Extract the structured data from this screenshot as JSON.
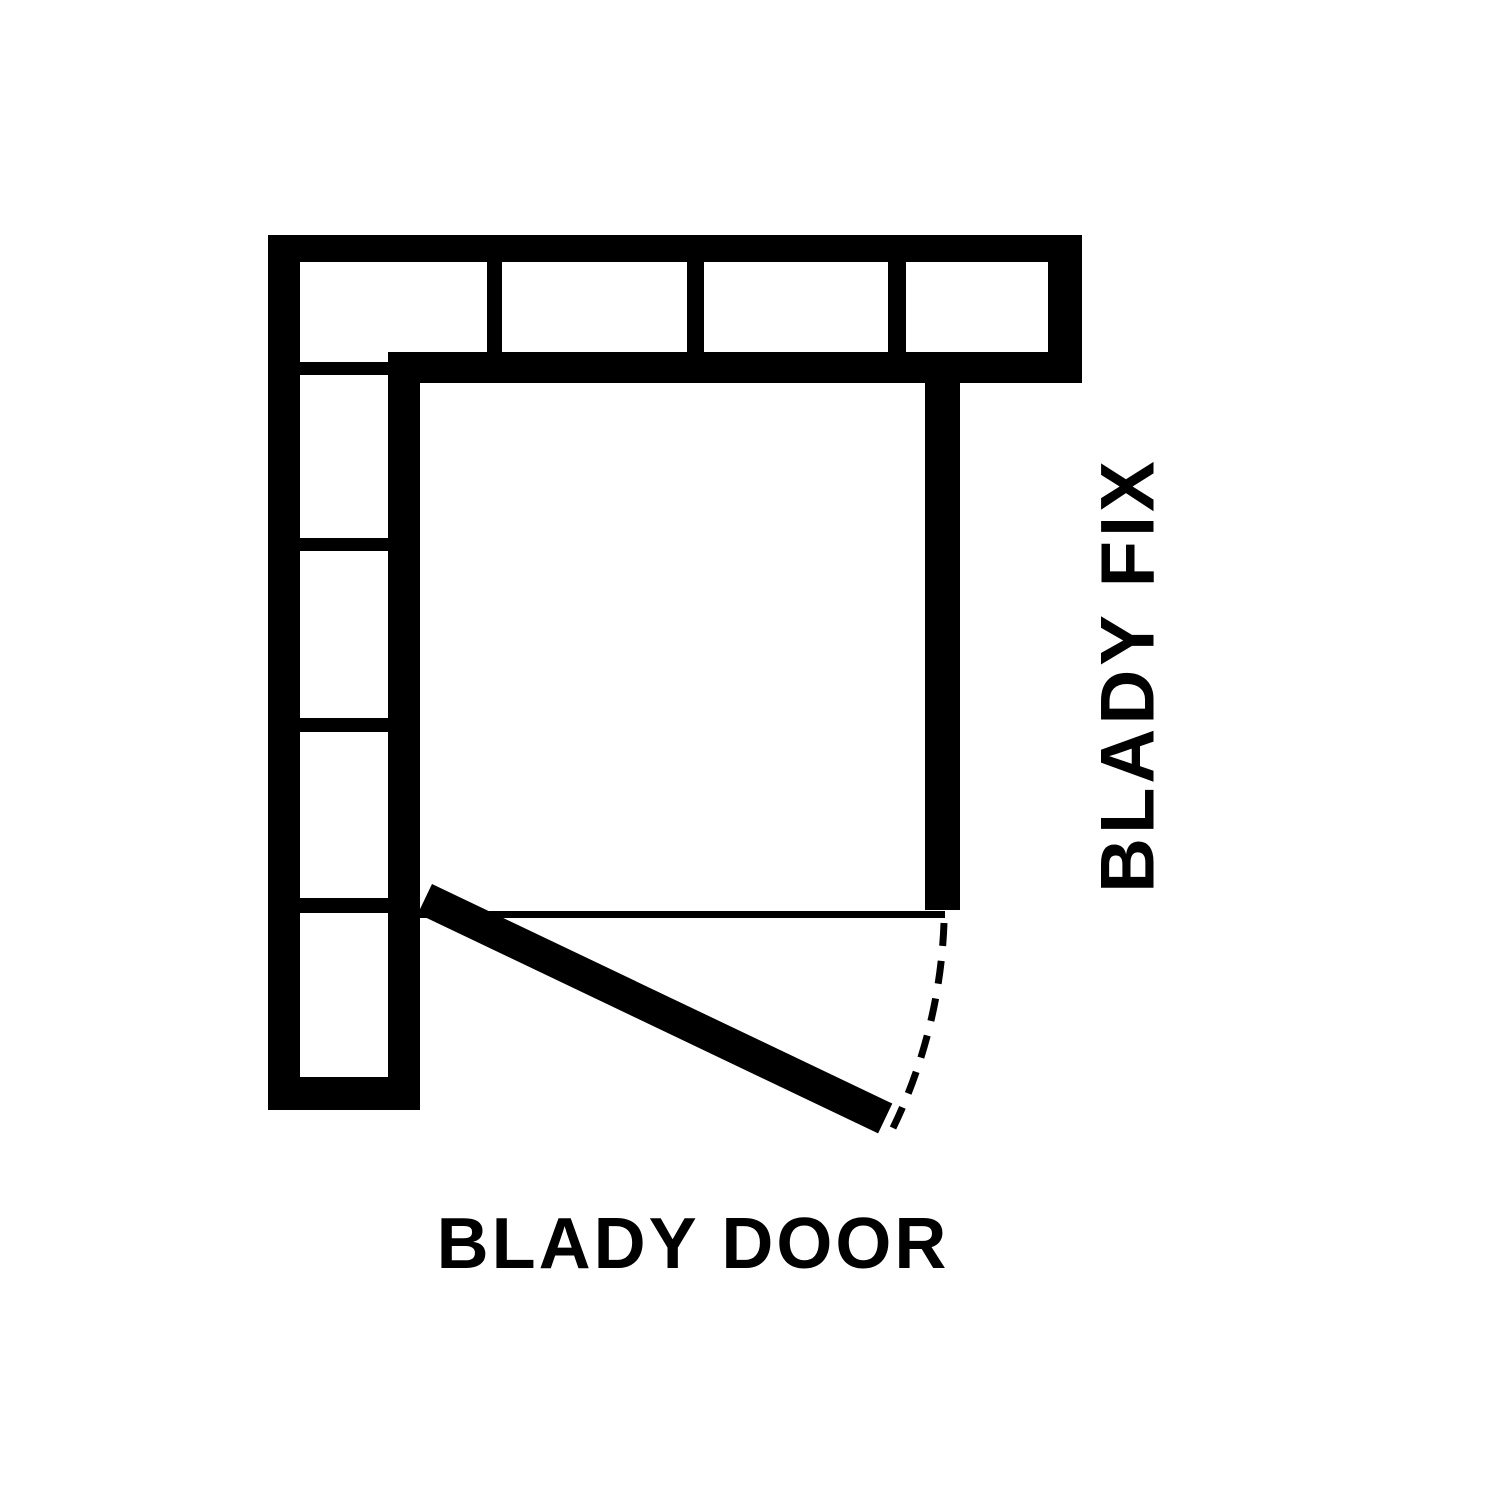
{
  "title": "Shower enclosure plan diagram",
  "colors": {
    "ink": "#000000",
    "background": "#ffffff"
  },
  "labels": {
    "fix_panel": "BLADY FIX",
    "door_panel": "BLADY DOOR"
  }
}
